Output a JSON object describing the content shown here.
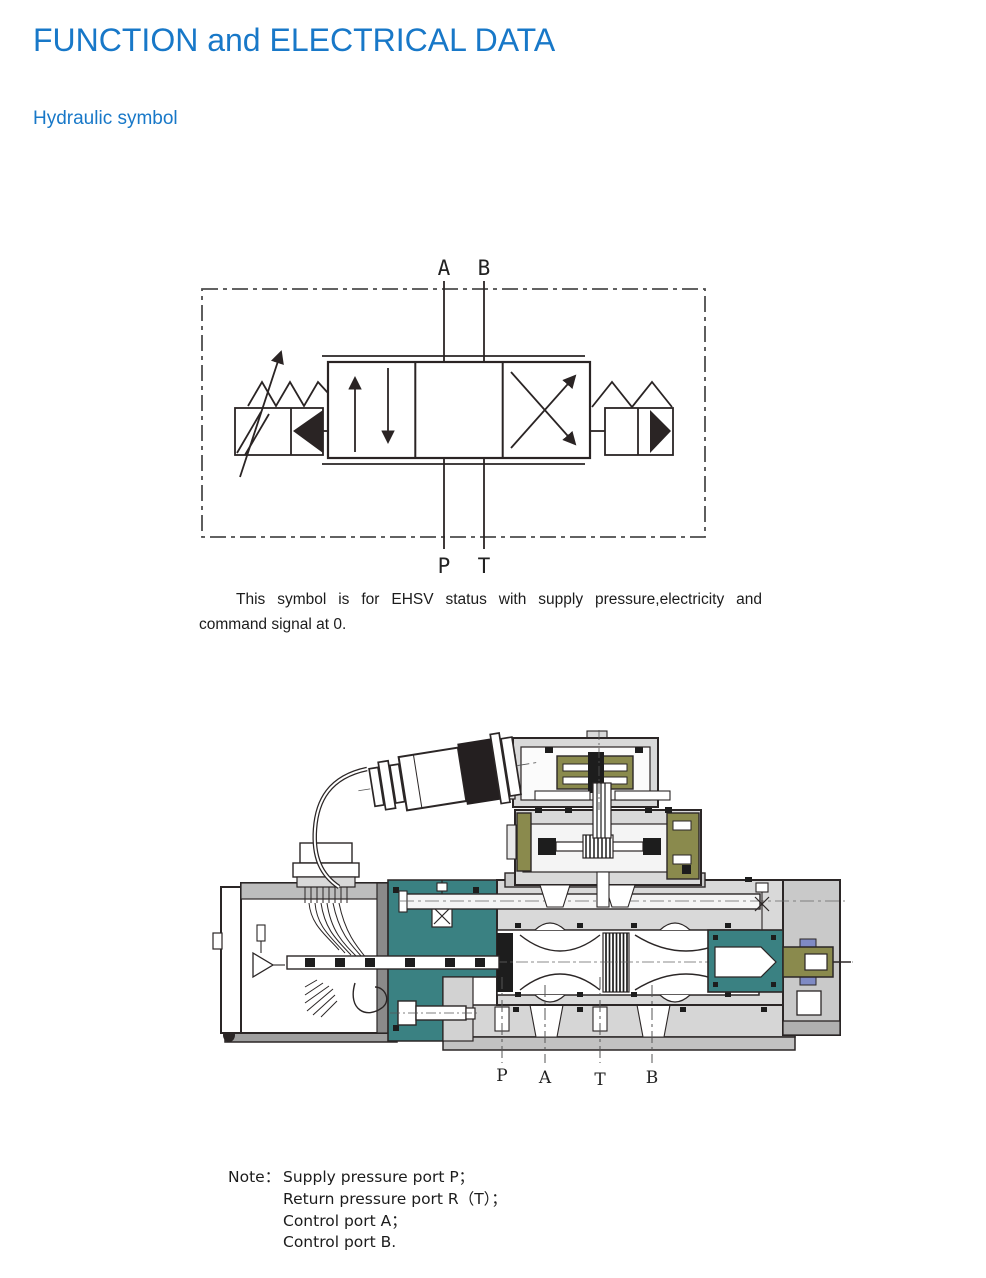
{
  "page": {
    "title": "FUNCTION and ELECTRICAL DATA",
    "section_heading": "Hydraulic symbol"
  },
  "hydraulic_symbol": {
    "port_top_left": "A",
    "port_top_right": "B",
    "port_bottom_left": "P",
    "port_bottom_right": "T",
    "caption_line1": "This symbol is for EHSV status with supply pressure,electricity and",
    "caption_line2": "command signal at 0."
  },
  "cross_section": {
    "ports": [
      "P",
      "A",
      "T",
      "B"
    ]
  },
  "note": {
    "label": "Note：",
    "lines": [
      "Supply pressure port P；",
      "Return pressure port R（T）；",
      "Control port A；",
      "Control port B."
    ]
  },
  "colors": {
    "heading_blue": "#1878c8",
    "drawing_teal": "#3a8182",
    "drawing_olive": "#8a8a4d",
    "drawing_accent_blue": "#7f8ac4"
  }
}
